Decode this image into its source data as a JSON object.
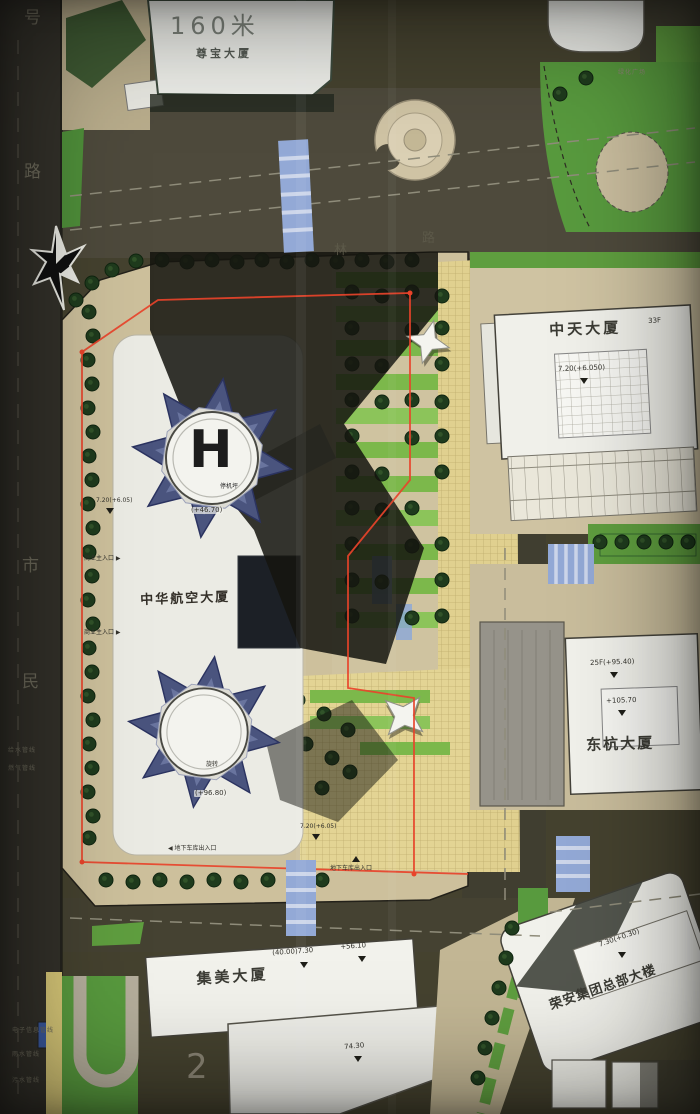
{
  "title": "总平面图",
  "streets": {
    "left_top": "号",
    "left_mid": "路",
    "left_lower": "市",
    "left_bottom": "民",
    "top_road_1": "林",
    "top_road_2": "路",
    "road_number": "2"
  },
  "buildings": {
    "zunbao": {
      "height": "160米",
      "name": "尊宝大厦"
    },
    "zhongtian": {
      "name": "中天大厦",
      "elevation": "7.20(+6.050)",
      "floors": "33F"
    },
    "zhonghua": {
      "name": "中华航空大厦",
      "helipad_letter": "H",
      "helipad_label": "停机坪",
      "helipad_elevation": "(+46.70)",
      "tower2_label": "旋转",
      "tower2_elevation": "(+96.80)"
    },
    "donghang": {
      "name": "东杭大厦",
      "floors": "25F(+95.40)",
      "elevation": "+105.70"
    },
    "jimei": {
      "name": "集美大厦",
      "elevation_1": "(40.00)7.30",
      "elevation_2": "+56.10",
      "elevation_3": "74.30"
    },
    "rongan": {
      "name": "荣安集团总部大楼",
      "elevation": "7.30(+0.30)"
    }
  },
  "entrances": {
    "commercial_upper": "商业主入口 ▶",
    "commercial_lower": "商业主入口 ▶",
    "garage_sw": "◀ 地下车库出入口",
    "garage_s": "地下车库出入口"
  },
  "elevation_marks": {
    "site_upper": "7.20(+6.05)",
    "site_lower": "7.20(+6.05)"
  },
  "utility_notes": {
    "n1": "电子信息管线",
    "n2": "雨水管线",
    "n3": "污水管线",
    "n4": "给水管线",
    "n5": "燃气管线"
  },
  "plaza_label": "绿化广场",
  "colors": {
    "boundary_red": "#e8432a",
    "crosswalk_blue": "#93a9d6",
    "tower_blue": "#4a547e",
    "lawn_green": "#589a3e",
    "paving_beige": "#cfc3a0"
  }
}
